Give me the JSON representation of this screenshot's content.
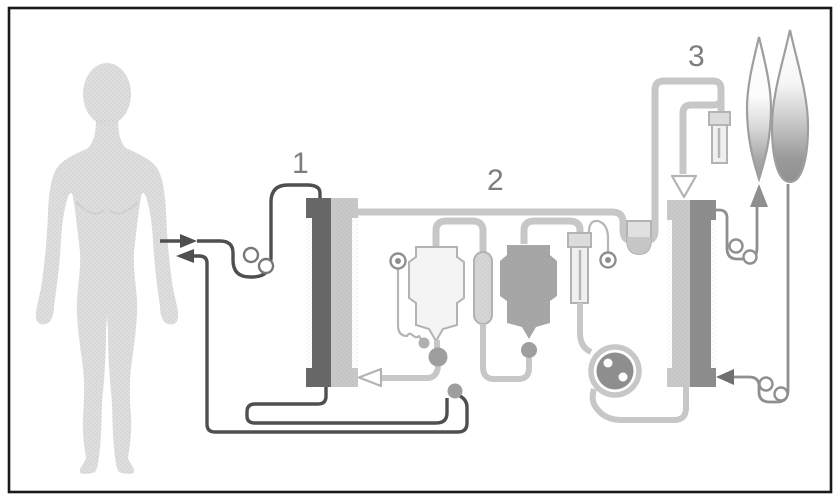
{
  "figure": {
    "description": "Therapeutic plasma-exchange circuit diagram",
    "labels": {
      "step1": "1",
      "step2": "2",
      "step3": "3"
    }
  },
  "colors": {
    "frame": "#1a1a1a",
    "background": "#ffffff",
    "body": "#dedede",
    "body_shade": "#cfcfcf",
    "tube_light": "#c7c7c7",
    "tube_dark": "#4f4f4f",
    "tube_medium": "#8f8f8f",
    "tube_thin": "#b5b5b5",
    "column1_dark": "#676767",
    "column1_light": "#c9c9c9",
    "column3_dark": "#8d8d8d",
    "column3_light": "#cacaca",
    "bag_white": "#f4f4f4",
    "bag_gray": "#a7a7a7",
    "pill": "#d6d6d6",
    "chamber": "#f0f0f0",
    "chamber_cap": "#dcdcdc",
    "cup": "#e0e0e0",
    "cup_fluid": "#c6c6c6",
    "pump": "#8e8e8e",
    "clamp": "#9e9e9e",
    "junction": "#9e9e9e",
    "arrow_up": "#8f8f8f",
    "arrow_dark": "#6f6f6f",
    "arrow_open": "#ffffff",
    "outline": "#b3b3b3",
    "label": "#7d7d7d",
    "drop_stroke": "#9e9e9e"
  }
}
